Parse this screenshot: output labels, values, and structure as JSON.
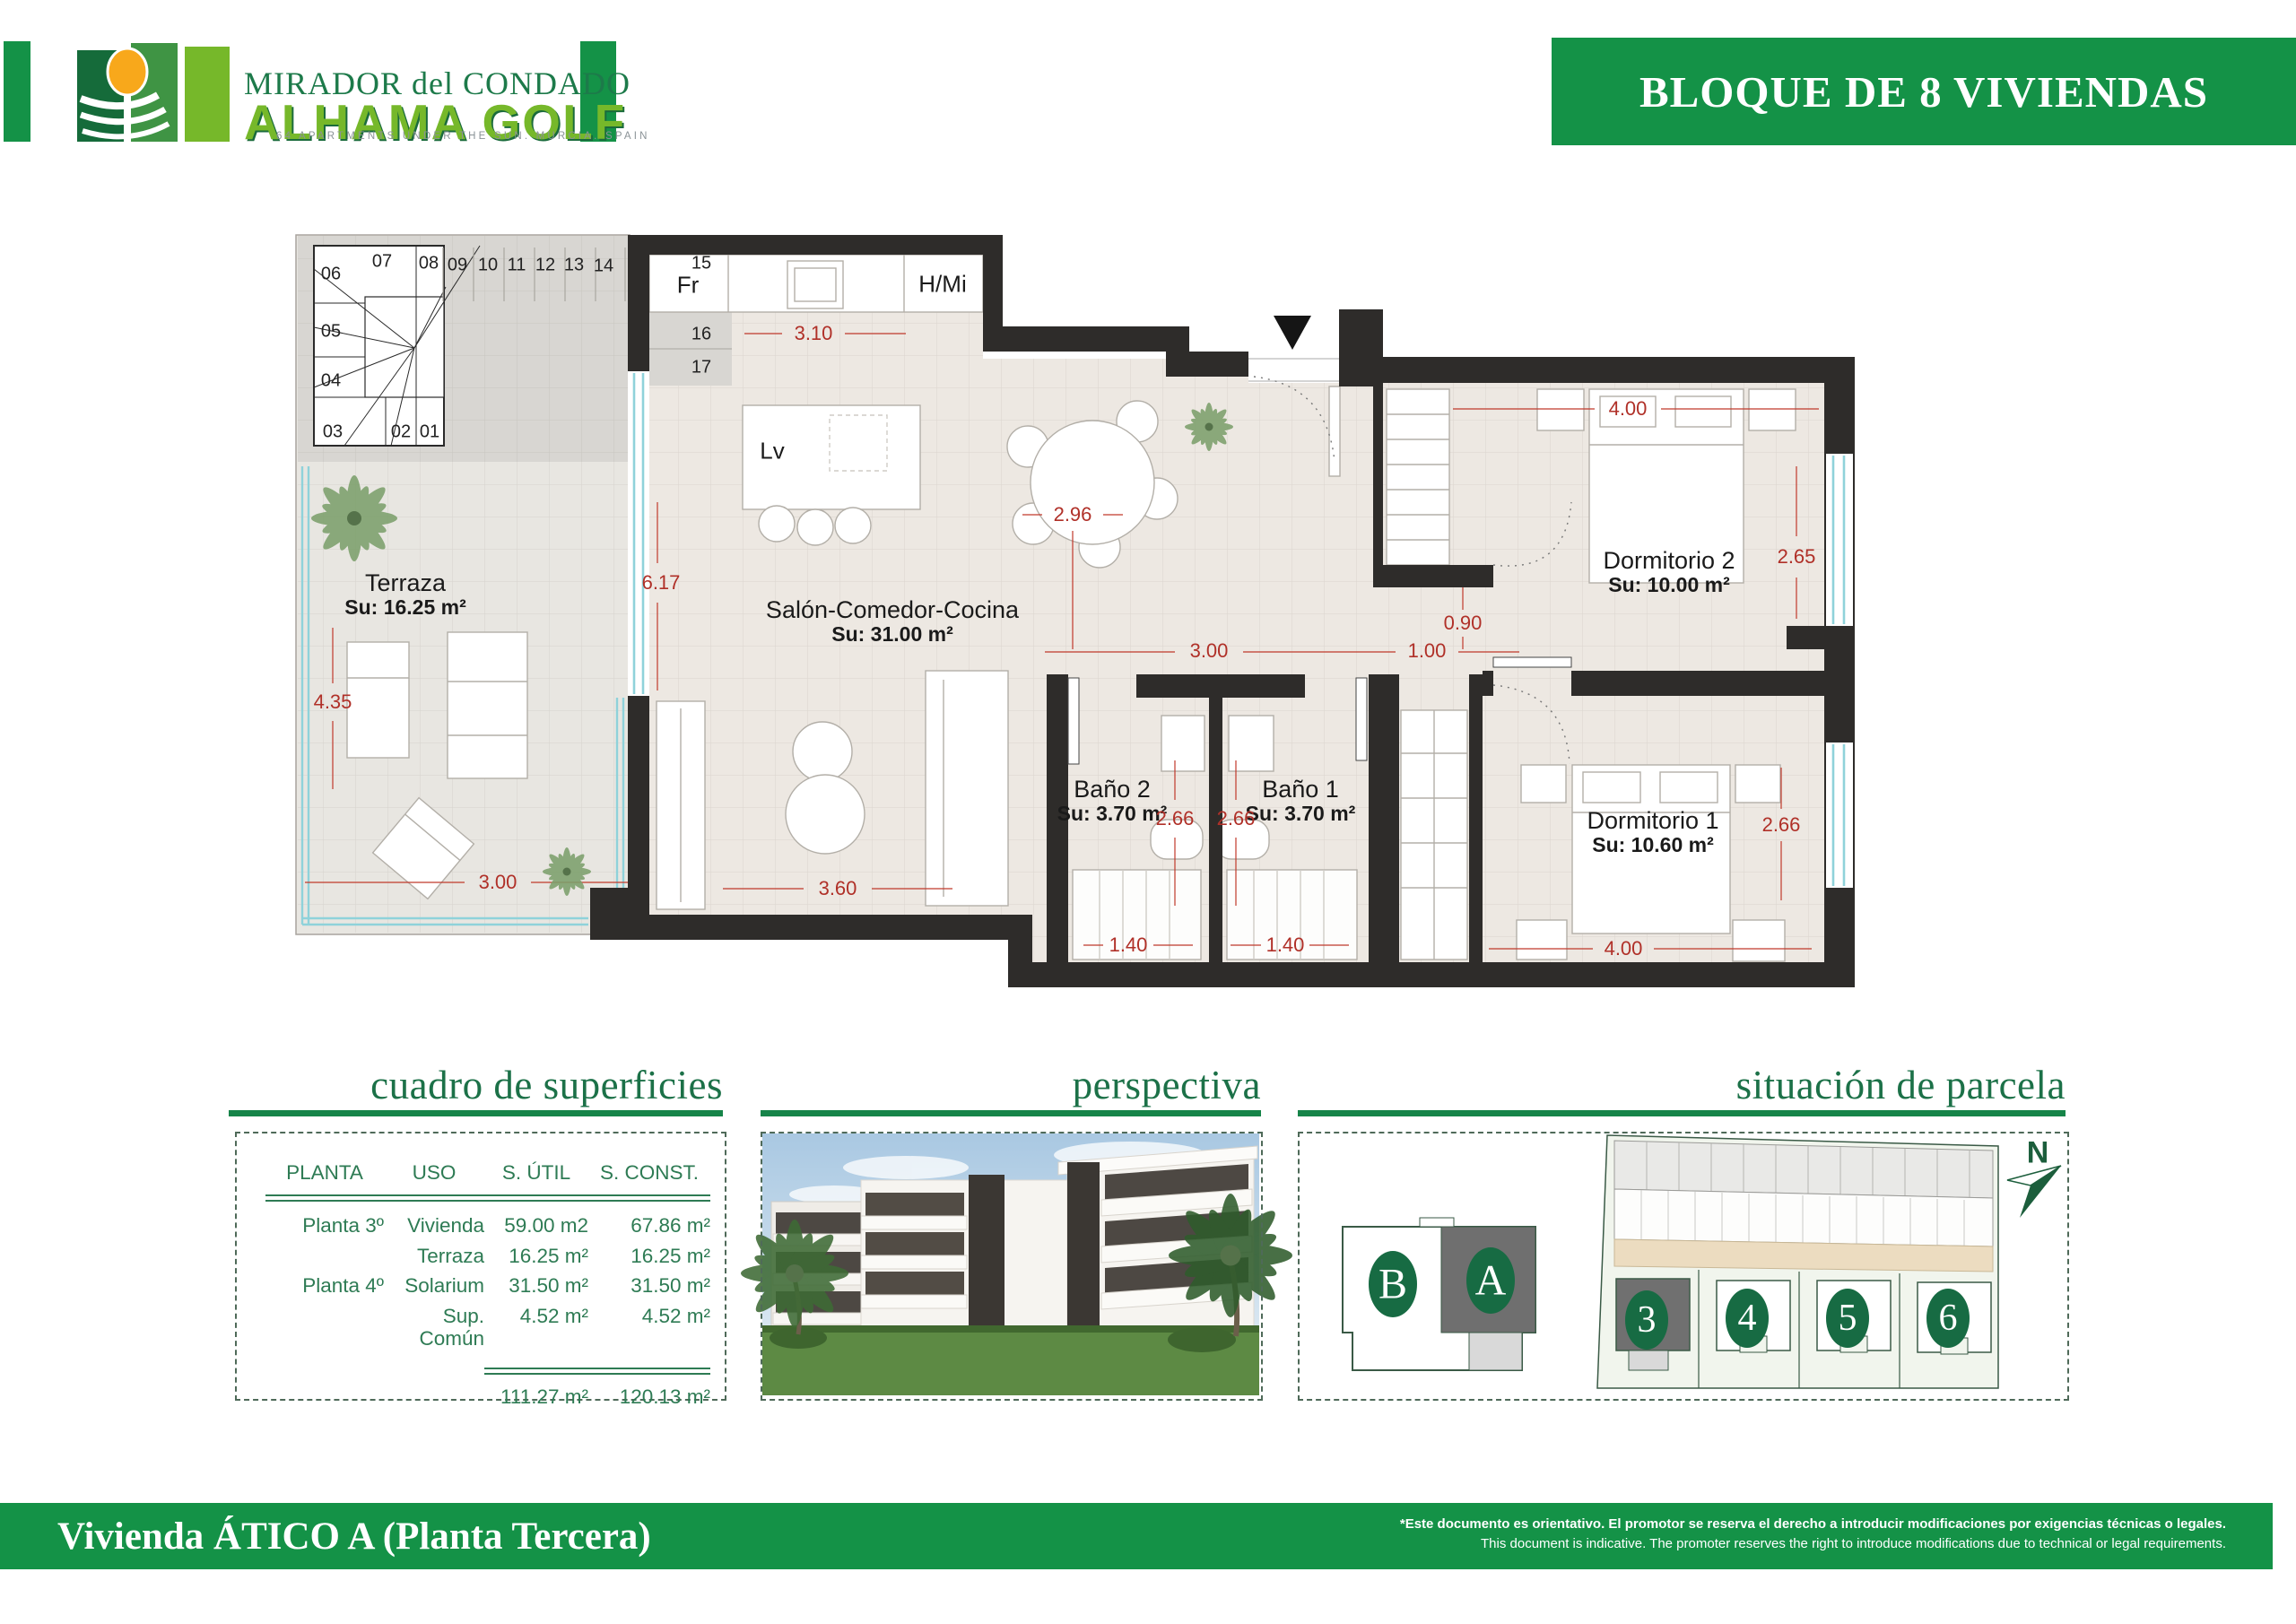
{
  "header": {
    "logo": {
      "title_line1": "MIRADOR del CONDADO",
      "title_line2": "ALHAMA GOLF",
      "tagline": "64 APARTMENTS UNDER THE SUN. MURCIA. SPAIN"
    },
    "banner_title": "BLOQUE DE 8 VIVIENDAS"
  },
  "plan": {
    "rooms": [
      {
        "name": "Terraza",
        "area": "Su: 16.25 m²"
      },
      {
        "name": "Salón-Comedor-Cocina",
        "area": "Su: 31.00 m²"
      },
      {
        "name": "Dormitorio 2",
        "area": "Su: 10.00 m²"
      },
      {
        "name": "Baño 2",
        "area": "Su: 3.70 m²"
      },
      {
        "name": "Baño 1",
        "area": "Su: 3.70 m²"
      },
      {
        "name": "Dormitorio 1",
        "area": "Su: 10.60 m²"
      }
    ],
    "appliances": {
      "fridge": "Fr",
      "oven_micro": "H/Mi",
      "dishwasher": "Lv"
    },
    "stairs": [
      "01",
      "02",
      "03",
      "04",
      "05",
      "06",
      "07",
      "08",
      "09",
      "10",
      "11",
      "12",
      "13",
      "14",
      "15",
      "16",
      "17"
    ],
    "dims": [
      "3.10",
      "2.96",
      "6.17",
      "4.35",
      "3.00",
      "3.60",
      "3.00",
      "1.00",
      "0.90",
      "4.00",
      "2.65",
      "2.66",
      "2.66",
      "1.40",
      "1.40",
      "4.00",
      "2.66"
    ]
  },
  "panels": {
    "surfaces": {
      "title": "cuadro de superficies",
      "columns": [
        "PLANTA",
        "USO",
        "S. ÚTIL",
        "S. CONST."
      ],
      "rows": [
        {
          "planta": "Planta 3º",
          "uso": "Vivienda",
          "util": "59.00 m2",
          "const": "67.86 m²"
        },
        {
          "planta": "",
          "uso": "Terraza",
          "util": "16.25 m²",
          "const": "16.25 m²"
        },
        {
          "planta": "Planta 4º",
          "uso": "Solarium",
          "util": "31.50 m²",
          "const": "31.50 m²"
        },
        {
          "planta": "",
          "uso": "Sup. Común",
          "util": "4.52 m²",
          "const": "4.52 m²"
        }
      ],
      "total_util": "111.27 m²",
      "total_const": "120.13 m²"
    },
    "perspective": {
      "title": "perspectiva"
    },
    "site": {
      "title": "situación de parcela",
      "block_b": "B",
      "block_a": "A",
      "parcels": [
        "3",
        "4",
        "5",
        "6"
      ],
      "north": "N"
    }
  },
  "footer": {
    "title": "Vivienda ÁTICO A (Planta Tercera)",
    "disclaimer_es": "*Este documento es orientativo. El promotor se reserva el derecho a introducir modificaciones por exigencias técnicas o legales.",
    "disclaimer_en": "This document is indicative. The promoter reserves the right to introduce modifications due to technical or legal requirements."
  },
  "colors": {
    "brand_green": "#149247",
    "title_green": "#1c7148",
    "table_green": "#2e7b54",
    "dim_red": "#b03028",
    "wall": "#2e2c2a",
    "logo_light_green": "#76b82a",
    "logo_dark_green": "#1d7a4a"
  }
}
